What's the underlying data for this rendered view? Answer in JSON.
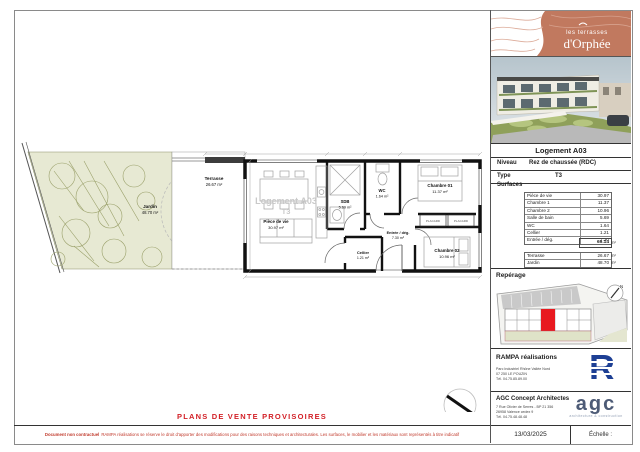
{
  "brand": {
    "line1": "les terrasses",
    "line2": "d'Orphée"
  },
  "plan": {
    "watermark_line1": "Logement A03",
    "watermark_line2": "T3",
    "jardin": {
      "name": "Jardin",
      "area": "48.70 m²"
    },
    "terrasse": {
      "name": "Terrasse",
      "area": "26.67 m²"
    },
    "rooms": [
      {
        "name": "Pièce de vie",
        "area": "30.97 m²"
      },
      {
        "name": "SDB",
        "area": "5.69 m²"
      },
      {
        "name": "WC",
        "area": "1.64 m²"
      },
      {
        "name": "Chambre 01",
        "area": "11.37 m²"
      },
      {
        "name": "Entrée / dég.",
        "area": "7.30 m²"
      },
      {
        "name": "Cellier",
        "area": "1.21 m²"
      },
      {
        "name": "Chambre 02",
        "area": "10.96 m²"
      }
    ],
    "placard_label": "PLACARD",
    "north_label": "N"
  },
  "panel": {
    "title": "Logement A03",
    "niveau_label": "Niveau",
    "niveau_value": "Rez de chaussée (RDC)",
    "type_label": "Type",
    "type_value": "T3",
    "surfaces_label": "Surfaces",
    "rows": [
      {
        "label": "Pièce de vie",
        "value": "30.97"
      },
      {
        "label": "Chambre 1",
        "value": "11.37"
      },
      {
        "label": "Chambre 2",
        "value": "10.96"
      },
      {
        "label": "Salle de bain",
        "value": "5.69"
      },
      {
        "label": "WC",
        "value": "1.64"
      },
      {
        "label": "Cellier",
        "value": "1.21"
      },
      {
        "label": "Entrée / dég.",
        "value": "7.30"
      }
    ],
    "total_value": "69.14",
    "unit": "m²",
    "extra_rows": [
      {
        "label": "Terrasse",
        "value": "26.67"
      },
      {
        "label": "Jardin",
        "value": "48.70"
      }
    ]
  },
  "reperage": {
    "title": "Repérage",
    "north_label": "N"
  },
  "rampa": {
    "title": "RAMPA réalisations",
    "address": [
      "Parc Industriel Rhône Vallée Nord",
      "07 250 LE POUZIN",
      "Tél. 04.75.85.89.00"
    ],
    "logo_letter": "R"
  },
  "agc": {
    "title": "AGC Concept Architectes",
    "address": [
      "7 Rue Olivier de Serres - BP 21 356",
      "26958 Valence cedex 9",
      "Tél. 04.75.48.48.48"
    ],
    "logo": "agc",
    "logo_sub": "architecture & construction"
  },
  "footer": {
    "title": "PLANS DE VENTE PROVISOIRES",
    "disclaimer_bold": "Document non contractuel",
    "disclaimer_rest": "RAMPA réalisations se réserve le droit d'apporter des modifications pour des raisons techniques et architecturales. Les surfaces, le mobilier et les matériaux sont représentés à titre indicatif",
    "date": "13/03/2025",
    "echelle_label": "Échelle :"
  },
  "colors": {
    "terracotta": "#c1795f",
    "red": "#d21f26",
    "site_red": "#e8191f",
    "garden": "#e7e9d3",
    "rampa_blue": "#1d3f94",
    "agc_blue": "#4d5b76"
  }
}
